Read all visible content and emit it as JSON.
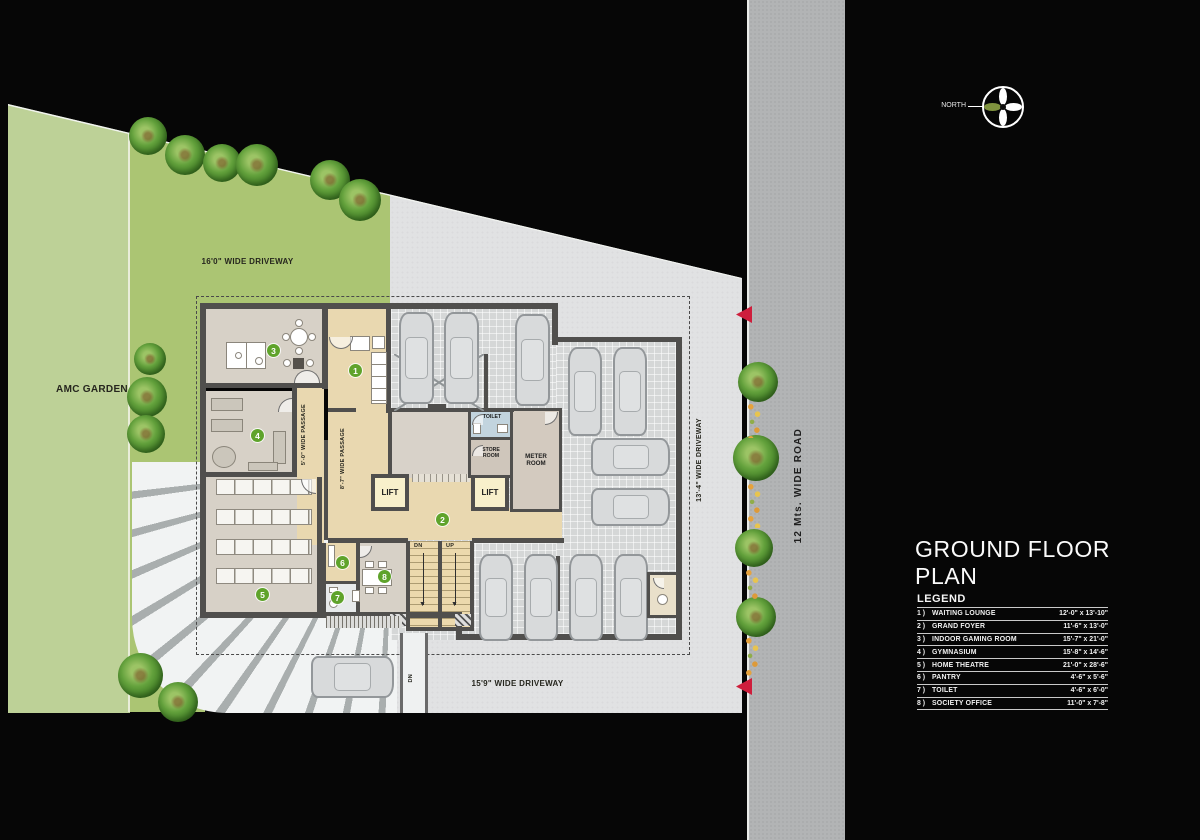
{
  "plan": {
    "labels": {
      "amc": "AMC GARDEN",
      "drv_top": "16'0\" WIDE DRIVEWAY",
      "drv_right": "13'-4\" WIDE DRIVEWAY",
      "drv_bottom": "15'9\" WIDE DRIVEWAY",
      "road": "12 Mts. WIDE ROAD",
      "passage5": "5'-0\" WIDE PASSAGE",
      "passage8": "8'-7\" WIDE PASSAGE",
      "north": "NORTH",
      "dn": "DN",
      "up": "UP",
      "ramp_dn": "DN",
      "lift": "LIFT",
      "toilet": "TOILET",
      "store": "STORE ROOM",
      "meter": "METER ROOM"
    },
    "badges": [
      "1",
      "2",
      "3",
      "4",
      "5",
      "6",
      "7",
      "8"
    ]
  },
  "panel": {
    "title_line1": "GROUND FLOOR",
    "title_line2": "PLAN",
    "legend_title": "LEGEND",
    "legend": [
      {
        "num": "1 )",
        "name": "WAITING LOUNGE",
        "dim": "12'-0\" x 13'-10\""
      },
      {
        "num": "2 )",
        "name": "GRAND FOYER",
        "dim": "11'-6\" x 13'-0\""
      },
      {
        "num": "3 )",
        "name": "INDOOR GAMING ROOM",
        "dim": "15'-7\" x 21'-0\""
      },
      {
        "num": "4 )",
        "name": "GYMNASIUM",
        "dim": "15'-8\" x 14'-6\""
      },
      {
        "num": "5 )",
        "name": "HOME THEATRE",
        "dim": "21'-0\" x 28'-6\""
      },
      {
        "num": "6 )",
        "name": "PANTRY",
        "dim": "4'-6\" x 5'-6\""
      },
      {
        "num": "7 )",
        "name": "TOILET",
        "dim": "4'-6\" x 6'-0\""
      },
      {
        "num": "8 )",
        "name": "SOCIETY OFFICE",
        "dim": "11'-0\" x 7'-8\""
      }
    ]
  },
  "colors": {
    "badge_green": "#5fa32b",
    "arrow_red": "#ce1e3c",
    "garden_green": "#bdd197",
    "driveway_green": "#abc573",
    "road_gray": "#b2b4b5",
    "foyer_tan": "#e9d8b0"
  }
}
